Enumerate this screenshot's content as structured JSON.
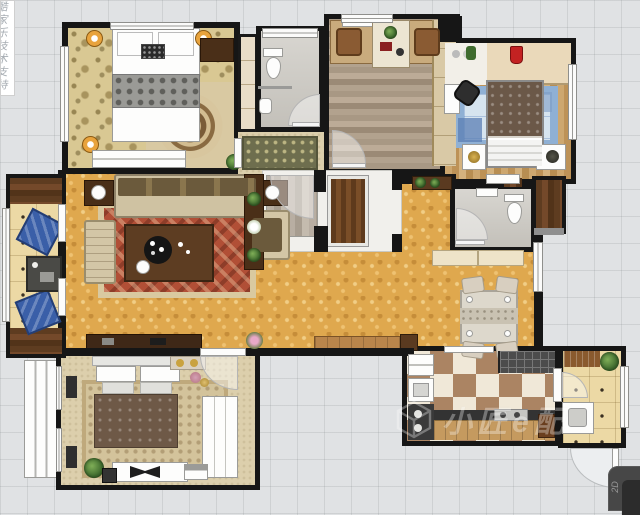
{
  "watermarks": {
    "left_vertical": "酷家乐技术支持",
    "brand_text": "小匠e配",
    "corner_badge": "2D"
  },
  "palette": {
    "canvas": "#e0e2e4",
    "wall": "#161616",
    "gold_floor": "#dfa84e",
    "damask_floor": "#d9c893",
    "tatami_floor": "#ecd9a5",
    "gray_tile": "#cbc8c1",
    "checker_brown": "#ab8463",
    "rug_red": "#b14f36",
    "rug_blue_border": "#8fb0d4",
    "dark_wood": "#5e3c20",
    "lamp_orange": "#e8a33d"
  },
  "floor_plan": {
    "rooms": [
      {
        "name": "bedroom-top-left",
        "floor": "floral damask carpet",
        "furniture": [
          "double-bed",
          "corner-lamp x3",
          "medallion-rug",
          "low-dresser",
          "dark-cabinet",
          "left-window"
        ]
      },
      {
        "name": "bathroom-top",
        "floor": "gray tile",
        "furniture": [
          "toilet",
          "washbasin",
          "partition",
          "door"
        ]
      },
      {
        "name": "closet-strip",
        "floor": "cream shelving",
        "furniture": []
      },
      {
        "name": "hallway-cloak",
        "floor": "beige carpet",
        "furniture": [
          "floral-runner-rug",
          "plant"
        ]
      },
      {
        "name": "study",
        "floor": "gray-brown plank wood",
        "furniture": [
          "double-desk",
          "chair x2",
          "center-bookcase-with-plant",
          "wall-shelf",
          "tall-cabinet",
          "door"
        ]
      },
      {
        "name": "bedroom-top-right",
        "floor": "tan plank wood",
        "furniture": [
          "wardrobe-band",
          "red-vase",
          "green-jar",
          "desk",
          "black-office-chair",
          "blue-patchwork-rug",
          "double-bed",
          "nightstand x2",
          "right-window"
        ]
      },
      {
        "name": "cloakroom-dark",
        "floor": "dark walnut planks",
        "furniture": []
      },
      {
        "name": "bathroom-right",
        "floor": "gray tile",
        "furniture": [
          "toilet",
          "washbasin",
          "door",
          "sideboard-outside"
        ]
      },
      {
        "name": "living-room",
        "floor": "golden parquet",
        "furniture": [
          "sofa",
          "chaise",
          "armchair",
          "lamp-side-table x2",
          "red-rug",
          "coffee-table-with-tray",
          "tv-cabinet",
          "media-bench",
          "plant-console",
          "flower-pot"
        ]
      },
      {
        "name": "entry-foyer",
        "floor": "gray planks / white",
        "furniture": [
          "entry-door",
          "door-arc"
        ]
      },
      {
        "name": "dining-area",
        "floor": "golden parquet",
        "furniture": [
          "dining-table",
          "dining-chair x4",
          "wall-cabinet"
        ]
      },
      {
        "name": "kitchen",
        "floor": "brown-cream checker",
        "furniture": [
          "fridge",
          "sink",
          "lower-counter",
          "stove",
          "drying-counter",
          "wood-counter",
          "brown-cabinet"
        ]
      },
      {
        "name": "balcony-right",
        "floor": "tatami grid",
        "furniture": [
          "washing-machine",
          "plant",
          "mat",
          "exit-door-arc"
        ]
      },
      {
        "name": "bedroom-bottom-left",
        "floor": "beige carpet",
        "furniture": [
          "double-bed",
          "ornate-rug",
          "wardrobe",
          "dresser-with-tv",
          "bench",
          "plant",
          "bay-window"
        ]
      },
      {
        "name": "balcony-left",
        "floor": "tatami grid",
        "furniture": [
          "floor-cushion x2",
          "tea-table",
          "wood-deck x2",
          "window-wall"
        ]
      }
    ]
  }
}
